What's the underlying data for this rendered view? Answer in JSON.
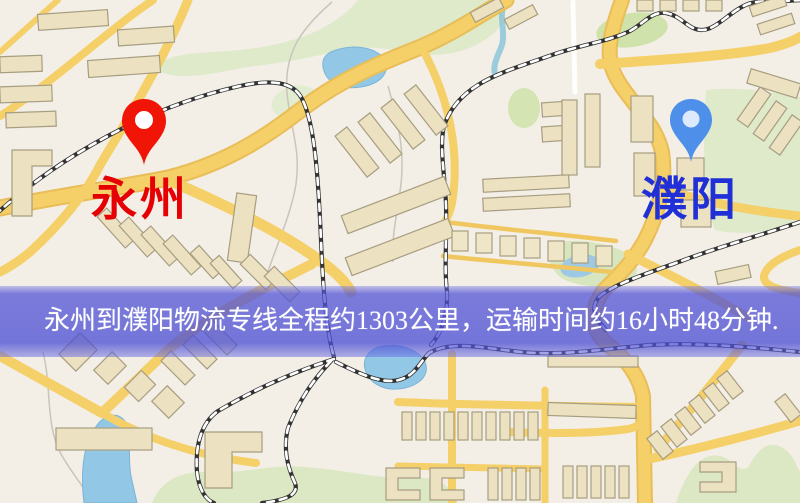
{
  "map": {
    "origin": {
      "name": "永州",
      "pin_color": "#f01507",
      "pin_hole_color": "#ffffff",
      "label_color": "#e60003"
    },
    "destination": {
      "name": "濮阳",
      "pin_color": "#4e8fe9",
      "pin_hole_color": "#ddeafd",
      "label_color": "#2130d6"
    },
    "info_banner": {
      "text": "永州到濮阳物流专线全程约1303公里，运输时间约16小时48分钟.",
      "text_color": "#ffffff",
      "overlay_color": "#4e50d4"
    },
    "map_colors": {
      "background": "#f3efe7",
      "road_major": "#f5cf68",
      "road_casing": "#e9bd58",
      "park_green": "#dde9c6",
      "water_blue": "#92c8e6",
      "railway_dark": "#333333",
      "building_fill": "#ece2c2",
      "building_outline": "#a79d80"
    }
  }
}
